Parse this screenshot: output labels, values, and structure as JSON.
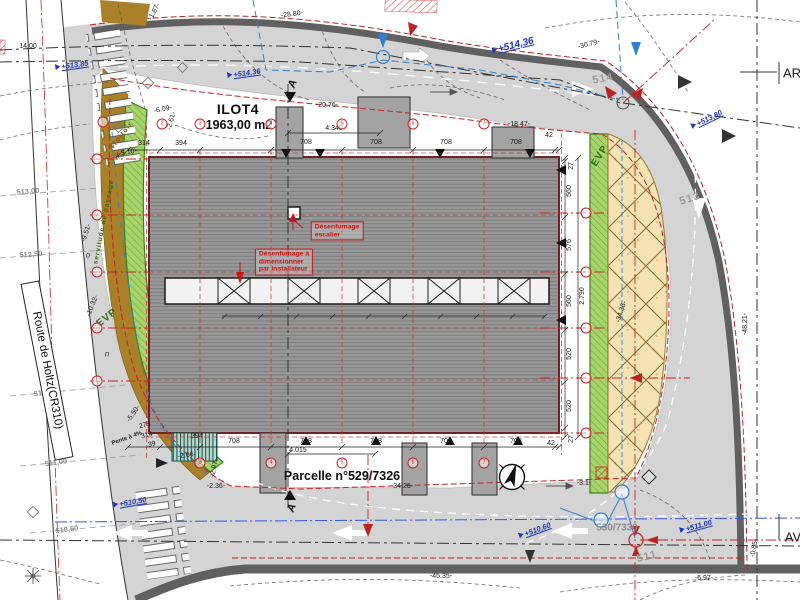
{
  "plan_type": "architectural site plan",
  "colors": {
    "road": "#d4d4d4",
    "curb": "#606060",
    "building": "#979797",
    "building_line": "#7e7e7e",
    "green": "#a9d46c",
    "green_dark": "#3f7d1d",
    "yellow": "#f5e3b3",
    "yellow_line": "#8a6a30",
    "brown": "#aa8028",
    "red": "#cc2222",
    "blue": "#1e34c8",
    "cyan_blue": "#2f7fd6",
    "gray_text": "#8c8c8c"
  },
  "plot": {
    "name": "ILOT4",
    "area": "1963,00 m2",
    "parcel": "Parcelle n°529/7326",
    "parcel_adjacent": "530/7330",
    "road_name": "Route de Holtz(CR310)",
    "edge_right_top": "AR",
    "edge_right_bottom": "AV"
  },
  "notes": {
    "vent1": "Désenfumage\nescalier",
    "vent2": "Désenfumage à\ndimensionner\npar installateur"
  },
  "icons": {
    "north_arrow": "north-arrow-compass"
  },
  "labels": [
    {
      "t": "-1.87-",
      "x": 155,
      "y": 12,
      "r": -62,
      "c": "dim"
    },
    {
      "t": "-28.80-",
      "x": 292,
      "y": 15,
      "r": -8,
      "c": "dim"
    },
    {
      "t": "-30.79-",
      "x": 589,
      "y": 45,
      "r": -14,
      "c": "dim"
    },
    {
      "t": "14.00",
      "x": 28,
      "y": 47,
      "r": 0,
      "c": "dim"
    },
    {
      "t": "-20.76-",
      "x": 327,
      "y": 106,
      "r": 0,
      "c": "dim"
    },
    {
      "t": "-6.09-",
      "x": 163,
      "y": 110,
      "r": -12,
      "c": "dim"
    },
    {
      "t": "-2.61-",
      "x": 172,
      "y": 121,
      "r": -75,
      "c": "dim"
    },
    {
      "t": "-18.47-",
      "x": 519,
      "y": 125,
      "r": 0,
      "c": "dim"
    },
    {
      "t": "-5.10-",
      "x": 128,
      "y": 153,
      "r": -10,
      "c": "dim"
    },
    {
      "t": "314",
      "x": 144,
      "y": 144,
      "r": 0,
      "c": "dim"
    },
    {
      "t": "394",
      "x": 181,
      "y": 144,
      "r": 0,
      "c": "dim"
    },
    {
      "t": "708",
      "x": 306,
      "y": 143,
      "r": 0,
      "c": "dim"
    },
    {
      "t": "708",
      "x": 376,
      "y": 143,
      "r": 0,
      "c": "dim"
    },
    {
      "t": "708",
      "x": 446,
      "y": 143,
      "r": 0,
      "c": "dim"
    },
    {
      "t": "708",
      "x": 516,
      "y": 143,
      "r": 0,
      "c": "dim"
    },
    {
      "t": "42",
      "x": 549,
      "y": 136,
      "r": 0,
      "c": "dim"
    },
    {
      "t": "4.340",
      "x": 334,
      "y": 129,
      "r": 0,
      "c": "dim"
    },
    {
      "t": "27",
      "x": 572,
      "y": 166,
      "r": -90,
      "c": "dim"
    },
    {
      "t": "560",
      "x": 570,
      "y": 191,
      "r": -90,
      "c": "dim"
    },
    {
      "t": "576",
      "x": 570,
      "y": 245,
      "r": -90,
      "c": "dim"
    },
    {
      "t": "560",
      "x": 570,
      "y": 301,
      "r": -90,
      "c": "dim"
    },
    {
      "t": "2.790",
      "x": 583,
      "y": 296,
      "r": -90,
      "c": "dim"
    },
    {
      "t": "520",
      "x": 570,
      "y": 354,
      "r": -90,
      "c": "dim"
    },
    {
      "t": "520",
      "x": 570,
      "y": 406,
      "r": -90,
      "c": "dim"
    },
    {
      "t": "27",
      "x": 572,
      "y": 439,
      "r": -90,
      "c": "dim"
    },
    {
      "t": "42",
      "x": 551,
      "y": 444,
      "r": 0,
      "c": "dim"
    },
    {
      "t": "708",
      "x": 234,
      "y": 442,
      "r": 0,
      "c": "dim"
    },
    {
      "t": "708",
      "x": 306,
      "y": 442,
      "r": 0,
      "c": "dim"
    },
    {
      "t": "708",
      "x": 376,
      "y": 442,
      "r": 0,
      "c": "dim"
    },
    {
      "t": "708",
      "x": 446,
      "y": 442,
      "r": 0,
      "c": "dim"
    },
    {
      "t": "708",
      "x": 516,
      "y": 442,
      "r": 0,
      "c": "dim"
    },
    {
      "t": "4.015",
      "x": 298,
      "y": 451,
      "r": 0,
      "c": "dim"
    },
    {
      "t": "394",
      "x": 197,
      "y": 437,
      "r": 0,
      "c": "dim"
    },
    {
      "t": "-2.06-",
      "x": 187,
      "y": 456,
      "r": -8,
      "c": "dim"
    },
    {
      "t": "275",
      "x": 145,
      "y": 426,
      "r": -15,
      "c": "dim"
    },
    {
      "t": "314",
      "x": 147,
      "y": 436,
      "r": -15,
      "c": "dim"
    },
    {
      "t": "39",
      "x": 152,
      "y": 445,
      "r": -15,
      "c": "dim"
    },
    {
      "t": "-2.97-",
      "x": 215,
      "y": 468,
      "r": -80,
      "c": "dim"
    },
    {
      "t": "-2.36-",
      "x": 216,
      "y": 487,
      "r": 0,
      "c": "dim"
    },
    {
      "t": "-3.1-",
      "x": 584,
      "y": 484,
      "r": 0,
      "c": "dim"
    },
    {
      "t": "-9.51-",
      "x": 87,
      "y": 233,
      "r": -72,
      "c": "dim"
    },
    {
      "t": "-10.32-",
      "x": 93,
      "y": 306,
      "r": -68,
      "c": "dim"
    },
    {
      "t": "-5.50-",
      "x": 134,
      "y": 414,
      "r": -55,
      "c": "dim"
    },
    {
      "t": "-45.35-",
      "x": 441,
      "y": 577,
      "r": 0,
      "c": "dim"
    },
    {
      "t": "-34.26-",
      "x": 402,
      "y": 487,
      "r": 0,
      "c": "dim"
    },
    {
      "t": "-34.36-",
      "x": 622,
      "y": 312,
      "r": -72,
      "c": "dim"
    },
    {
      "t": "-6.97-",
      "x": 704,
      "y": 579,
      "r": 0,
      "c": "dim"
    },
    {
      "t": "-48.21-",
      "x": 746,
      "y": 324,
      "r": -90,
      "c": "dim"
    },
    {
      "t": "-0.85-",
      "x": 755,
      "y": 548,
      "r": -80,
      "c": "dim"
    },
    {
      "t": "k",
      "x": 118,
      "y": 157,
      "r": 0,
      "c": "letter"
    },
    {
      "t": "o",
      "x": 88,
      "y": 256,
      "r": 0,
      "c": "letter"
    },
    {
      "t": "n",
      "x": 107,
      "y": 355,
      "r": 0,
      "c": "letter"
    },
    {
      "t": "513,00",
      "x": 28,
      "y": 192,
      "r": -5,
      "c": "contour"
    },
    {
      "t": "512,50",
      "x": 31,
      "y": 255,
      "r": -5,
      "c": "contour"
    },
    {
      "t": "511,50",
      "x": 45,
      "y": 393,
      "r": -8,
      "c": "contour"
    },
    {
      "t": "511,00",
      "x": 56,
      "y": 463,
      "r": -8,
      "c": "contour"
    },
    {
      "t": "510,50",
      "x": 67,
      "y": 530,
      "r": -8,
      "c": "contour"
    },
    {
      "t": "514",
      "x": 603,
      "y": 79,
      "r": -10,
      "c": "contour-big"
    },
    {
      "t": "513",
      "x": 690,
      "y": 199,
      "r": -18,
      "c": "contour-big"
    },
    {
      "t": "511",
      "x": 647,
      "y": 557,
      "r": -14,
      "c": "contour-big"
    },
    {
      "t": "530/7330",
      "x": 617,
      "y": 528,
      "r": 0,
      "c": "parcel2",
      "n": "parcel-530-7330-label"
    },
    {
      "t": "+513,85",
      "x": 72,
      "y": 66,
      "r": -8,
      "c": "blue",
      "n": "spot-elevation"
    },
    {
      "t": "+514,36",
      "x": 244,
      "y": 74,
      "r": -8,
      "c": "blue",
      "n": "spot-elevation"
    },
    {
      "t": "+514,36",
      "x": 513,
      "y": 46,
      "r": -14,
      "c": "blue-big",
      "n": "spot-elevation"
    },
    {
      "t": "+513,80",
      "x": 707,
      "y": 120,
      "r": -26,
      "c": "blue",
      "n": "spot-elevation"
    },
    {
      "t": "+510,50",
      "x": 130,
      "y": 503,
      "r": -10,
      "c": "blue",
      "n": "spot-elevation"
    },
    {
      "t": "+510,60",
      "x": 535,
      "y": 531,
      "r": -20,
      "c": "blue",
      "n": "spot-elevation"
    },
    {
      "t": "+511,00",
      "x": 696,
      "y": 527,
      "r": -15,
      "c": "blue",
      "n": "spot-elevation"
    },
    {
      "t": "ILOT4",
      "x": 238,
      "y": 110,
      "r": 0,
      "c": "title",
      "n": "ilot4-title"
    },
    {
      "t": "1963,00 m2",
      "x": 239,
      "y": 125,
      "r": 0,
      "c": "title2",
      "n": "ilot4-area"
    },
    {
      "t": "Parcelle n°529/7326",
      "x": 342,
      "y": 476,
      "r": 0,
      "c": "title2",
      "n": "parcelle-label"
    },
    {
      "t": "AR",
      "x": 792,
      "y": 74,
      "r": 0,
      "c": "edge",
      "n": "ar-label"
    },
    {
      "t": "AV",
      "x": 793,
      "y": 538,
      "r": 0,
      "c": "edge",
      "n": "av-label"
    },
    {
      "t": "A",
      "x": 293,
      "y": 84,
      "r": -70,
      "c": "section",
      "n": "section-a-top"
    },
    {
      "t": "A",
      "x": 292,
      "y": 508,
      "r": -70,
      "c": "section",
      "n": "section-a-bottom"
    },
    {
      "t": "EVP",
      "x": 107,
      "y": 318,
      "r": -38,
      "c": "evp",
      "n": "evp-left-label"
    },
    {
      "t": "EVP",
      "x": 600,
      "y": 156,
      "r": -58,
      "c": "evp",
      "n": "evp-right-label"
    },
    {
      "t": "servitude de passage",
      "x": 104,
      "y": 222,
      "r": -79,
      "c": "serv",
      "n": "servitude-label"
    },
    {
      "t": "Trottoir",
      "x": 122,
      "y": 136,
      "r": -52,
      "c": "trottoir",
      "n": "trottoir-label"
    },
    {
      "t": "Pente à 4%",
      "x": 127,
      "y": 439,
      "r": -20,
      "c": "pente",
      "n": "pente-label"
    },
    {
      "t": "Désenfumage\nescalier",
      "x": 337,
      "y": 231,
      "r": 0,
      "c": "rednote",
      "n": "note-desenfumage-escalier"
    },
    {
      "t": "Désenfumage à\ndimensionner\npar installateur",
      "x": 284,
      "y": 262,
      "r": 0,
      "c": "rednote",
      "n": "note-desenfumage-installateur"
    },
    {
      "t": "2",
      "x": 162,
      "y": 124,
      "r": 0,
      "c": "bubble",
      "n": "grid-bubble"
    },
    {
      "t": "3",
      "x": 200,
      "y": 124,
      "r": 0,
      "c": "bubble",
      "n": "grid-bubble"
    },
    {
      "t": "4",
      "x": 271,
      "y": 124,
      "r": 0,
      "c": "bubble",
      "n": "grid-bubble"
    },
    {
      "t": "5",
      "x": 342,
      "y": 124,
      "r": 0,
      "c": "bubble",
      "n": "grid-bubble"
    },
    {
      "t": "6",
      "x": 413,
      "y": 124,
      "r": 0,
      "c": "bubble",
      "n": "grid-bubble"
    },
    {
      "t": "7",
      "x": 484,
      "y": 124,
      "r": 0,
      "c": "bubble",
      "n": "grid-bubble"
    },
    {
      "t": "",
      "x": 103,
      "y": 122,
      "r": 0,
      "c": "bubble",
      "n": "grid-bubble"
    },
    {
      "t": "3",
      "x": 200,
      "y": 463,
      "r": 0,
      "c": "bubble",
      "n": "grid-bubble"
    },
    {
      "t": "4",
      "x": 271,
      "y": 463,
      "r": 0,
      "c": "bubble",
      "n": "grid-bubble"
    },
    {
      "t": "5",
      "x": 342,
      "y": 463,
      "r": 0,
      "c": "bubble",
      "n": "grid-bubble"
    },
    {
      "t": "6",
      "x": 413,
      "y": 463,
      "r": 0,
      "c": "bubble",
      "n": "grid-bubble"
    },
    {
      "t": "7",
      "x": 484,
      "y": 463,
      "r": 0,
      "c": "bubble",
      "n": "grid-bubble"
    },
    {
      "t": "",
      "x": 97,
      "y": 159,
      "r": 0,
      "c": "bubble",
      "n": "grid-bubble"
    },
    {
      "t": "",
      "x": 97,
      "y": 215,
      "r": 0,
      "c": "bubble",
      "n": "grid-bubble"
    },
    {
      "t": "",
      "x": 97,
      "y": 272,
      "r": 0,
      "c": "bubble",
      "n": "grid-bubble"
    },
    {
      "t": "",
      "x": 97,
      "y": 328,
      "r": 0,
      "c": "bubble",
      "n": "grid-bubble"
    },
    {
      "t": "",
      "x": 97,
      "y": 381,
      "r": 0,
      "c": "bubble",
      "n": "grid-bubble"
    },
    {
      "t": "",
      "x": 586,
      "y": 213,
      "r": 0,
      "c": "bubble",
      "n": "grid-bubble"
    },
    {
      "t": "",
      "x": 586,
      "y": 272,
      "r": 0,
      "c": "bubble",
      "n": "grid-bubble"
    },
    {
      "t": "",
      "x": 586,
      "y": 328,
      "r": 0,
      "c": "bubble",
      "n": "grid-bubble"
    },
    {
      "t": "",
      "x": 586,
      "y": 378,
      "r": 0,
      "c": "bubble",
      "n": "grid-bubble"
    },
    {
      "t": "",
      "x": 586,
      "y": 433,
      "r": 0,
      "c": "bubble",
      "n": "grid-bubble"
    }
  ]
}
